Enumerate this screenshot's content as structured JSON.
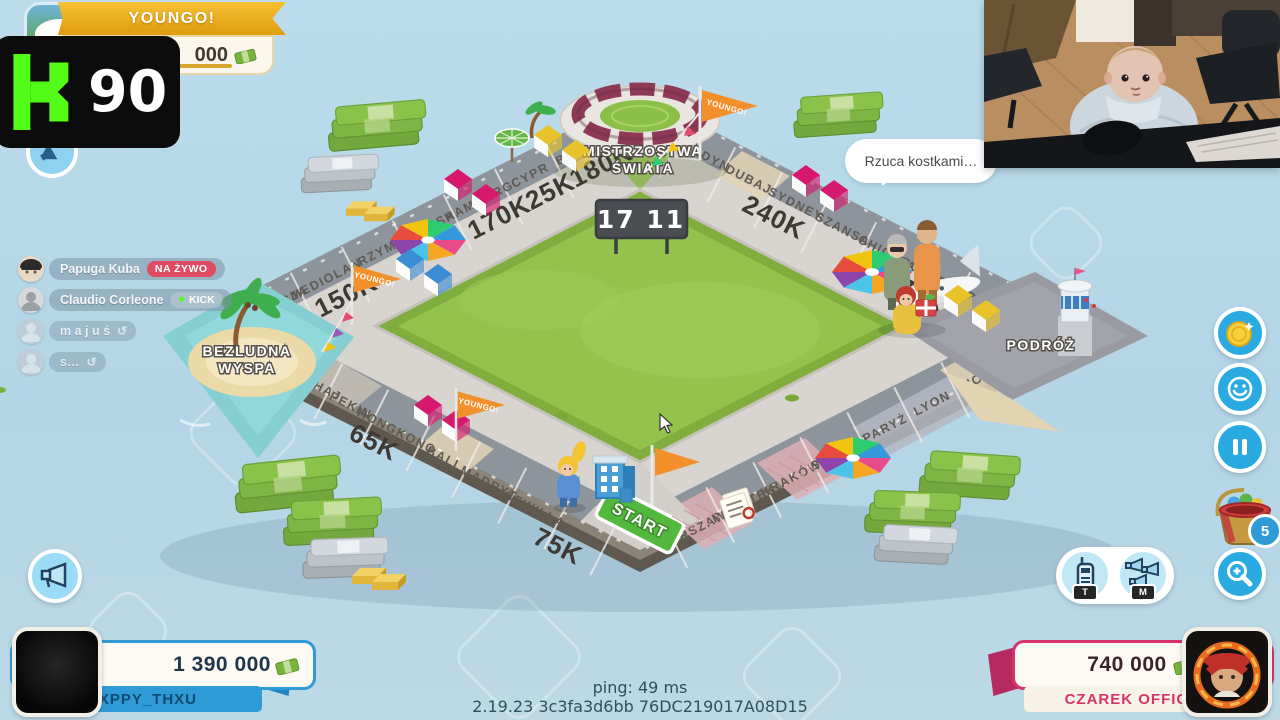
{
  "stream": {
    "banner_title": "YOUNGO!",
    "banner_money": "000",
    "kick_viewers": "90",
    "kick_logo_icon": "kick-k-icon"
  },
  "chat": {
    "rows": [
      {
        "name": "Papuga Kuba",
        "badge": "NA ŻYWO",
        "badge_type": "live"
      },
      {
        "name": "Claudio Corleone",
        "badge": "KICK",
        "badge_type": "kick"
      },
      {
        "name": "m a j u ś",
        "badge": "↺",
        "badge_type": "clock"
      },
      {
        "name": "s…",
        "badge": "↺",
        "badge_type": "clock"
      }
    ]
  },
  "icons": {
    "heart": "♥",
    "clock": "↺"
  },
  "board": {
    "scoreboard": "17 11",
    "speech_bubble": "Rzuca kostkami…",
    "flag_text": "YOUNGO!",
    "corners": {
      "top1": "MISTRZOSTWA",
      "top2": "ŚWIATA",
      "left1": "BEZLUDNA",
      "left2": "WYSPA",
      "bottom": "START",
      "right": "PODRÓŻ"
    },
    "sides": {
      "nw": [
        {
          "name": "BERLIN",
          "price": "180K"
        },
        {
          "name": "CYPR",
          "price": "25K"
        },
        {
          "name": "HAMBURG",
          "price": "170K"
        },
        {
          "name": "SZANSA"
        },
        {
          "name": "RZYM"
        },
        {
          "name": "MEDIOLAN",
          "price": "150K"
        },
        {
          "name": "WENECJA"
        }
      ],
      "sw": [
        {
          "name": "SZANGHAJ"
        },
        {
          "name": "PEKIN"
        },
        {
          "name": "HONGKONG",
          "price": "65K"
        },
        {
          "name": "BALI"
        },
        {
          "name": "MADRYT"
        },
        {
          "name": "SEWILLA"
        },
        {
          "name": "GRENADA",
          "price": "75K"
        }
      ],
      "se": [
        {
          "name": "WARSZAWA"
        },
        {
          "name": "PODATEK"
        },
        {
          "name": "KRAKÓW"
        },
        {
          "name": "SZANSA"
        },
        {
          "name": "PARYŻ"
        },
        {
          "name": "LYON"
        },
        {
          "name": "NICEA"
        }
      ],
      "ne": [
        {
          "name": "LONDYN"
        },
        {
          "name": "DUBAJ"
        },
        {
          "name": "SYDNEY",
          "price": "240K"
        },
        {
          "name": "SZANSA"
        },
        {
          "name": "CHICAGO"
        },
        {
          "name": "LAS VEGAS",
          "price": "270K"
        },
        {
          "name": "NOWY JORK"
        }
      ]
    }
  },
  "hud": {
    "bucket_badge": "5",
    "audio": [
      {
        "label": "T",
        "icon": "walkie-talkie-icon"
      },
      {
        "label": "M",
        "icon": "megaphones-icon"
      }
    ],
    "right_buttons": [
      "coin-icon",
      "smiley-icon",
      "pause-icon",
      "toy-bucket-icon",
      "zoom-in-icon"
    ],
    "left_button": "megaphone-icon",
    "accent_blue": "#29abe2",
    "kick_green": "#53fc18"
  },
  "players": {
    "left": {
      "money": "1 390 000",
      "name": "HXPPY_THXU",
      "color": "#2f9bd6"
    },
    "right": {
      "money": "740 000",
      "name": "CZAREK OFFICIAL",
      "color": "#d6336c"
    }
  },
  "footer": {
    "ping": "ping: 49 ms",
    "version": "2.19.23 3c3fa3d6bb 76DC219017A08D15"
  }
}
